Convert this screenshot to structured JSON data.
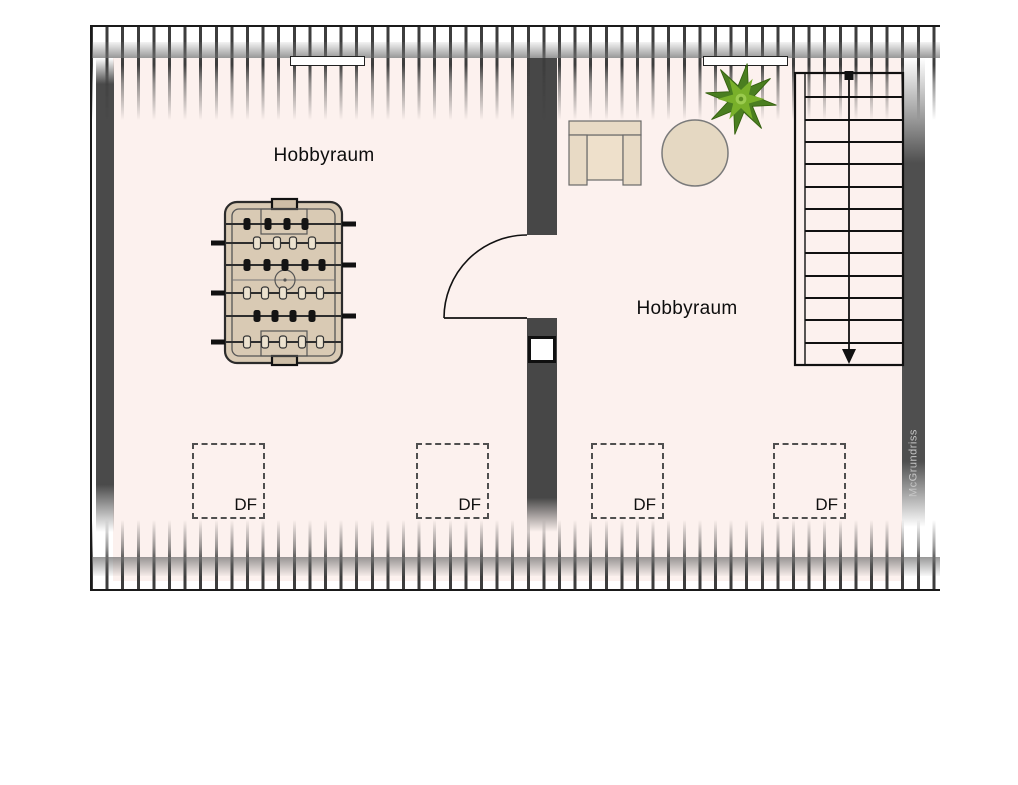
{
  "floorplan": {
    "type": "attic-floor-plan",
    "rooms": [
      {
        "label": "Hobbyraum"
      },
      {
        "label": "Hobbyraum"
      }
    ],
    "skylights": [
      {
        "label": "DF"
      },
      {
        "label": "DF"
      },
      {
        "label": "DF"
      },
      {
        "label": "DF"
      }
    ],
    "watermark": "McGrundriss",
    "stairs": {
      "steps": 13,
      "direction": "down"
    },
    "door": {
      "type": "swing",
      "opens_into": "left room"
    },
    "furniture": [
      "foosball-table",
      "armchair",
      "round-table",
      "potted-plant"
    ],
    "features": [
      "chimney-in-middle-wall",
      "two-roof-window-strips-top-wall",
      "hatched-knee-walls-top-bottom"
    ],
    "colors": {
      "floor": "#fcf1ee",
      "wall": "#4a4a4a",
      "hatch": "#3d3d3d",
      "wood": "#d9cab4",
      "plant_green": "#79b02a",
      "line": "#111111",
      "watermark_text": "#c6c6c6"
    }
  }
}
